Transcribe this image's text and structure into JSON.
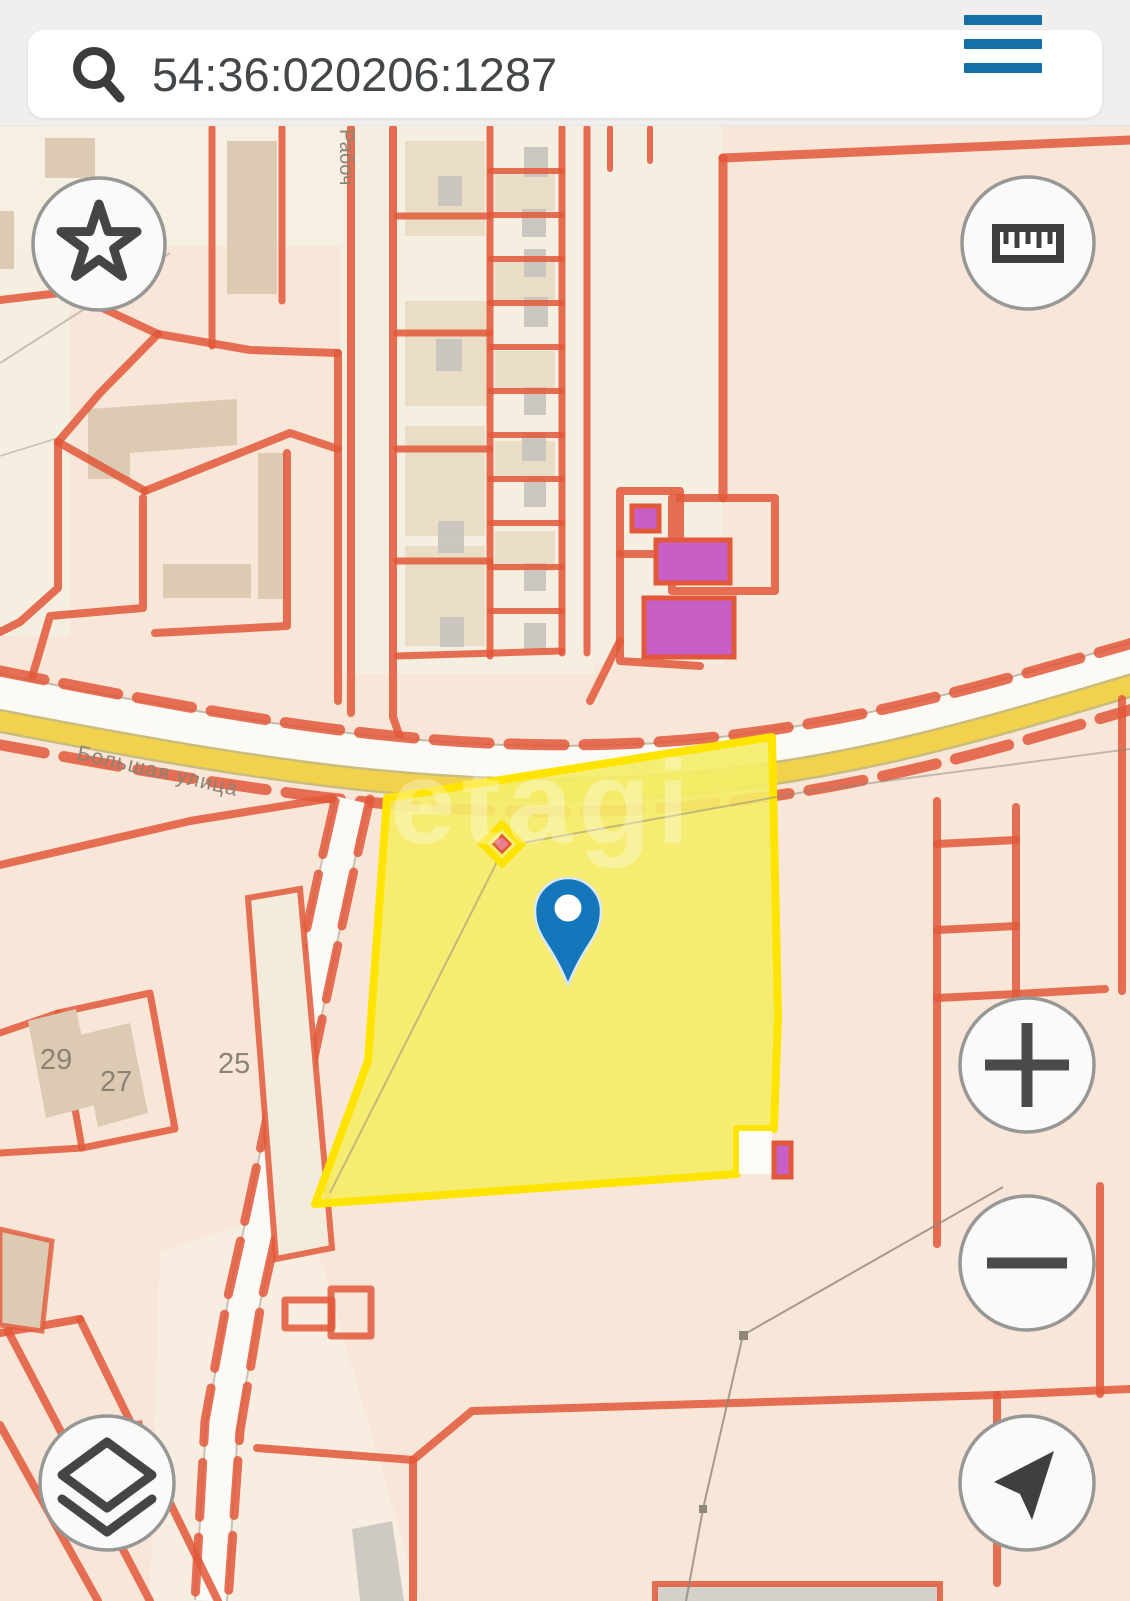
{
  "header": {
    "search_value": "54:36:020206:1287"
  },
  "map": {
    "street_main_label": "Большая улица",
    "street_side_label": "Рабоч",
    "watermark": "etagi",
    "building_numbers": {
      "left": "29",
      "middle": "27",
      "right": "25"
    },
    "colors": {
      "accent_orange": "#e2593a",
      "selected_parcel_fill": "#f4ed68",
      "selected_parcel_border": "#ffe400",
      "pin_blue": "#1576bb",
      "menu_blue": "#1470a6",
      "magenta_building": "#c75fc7"
    }
  }
}
